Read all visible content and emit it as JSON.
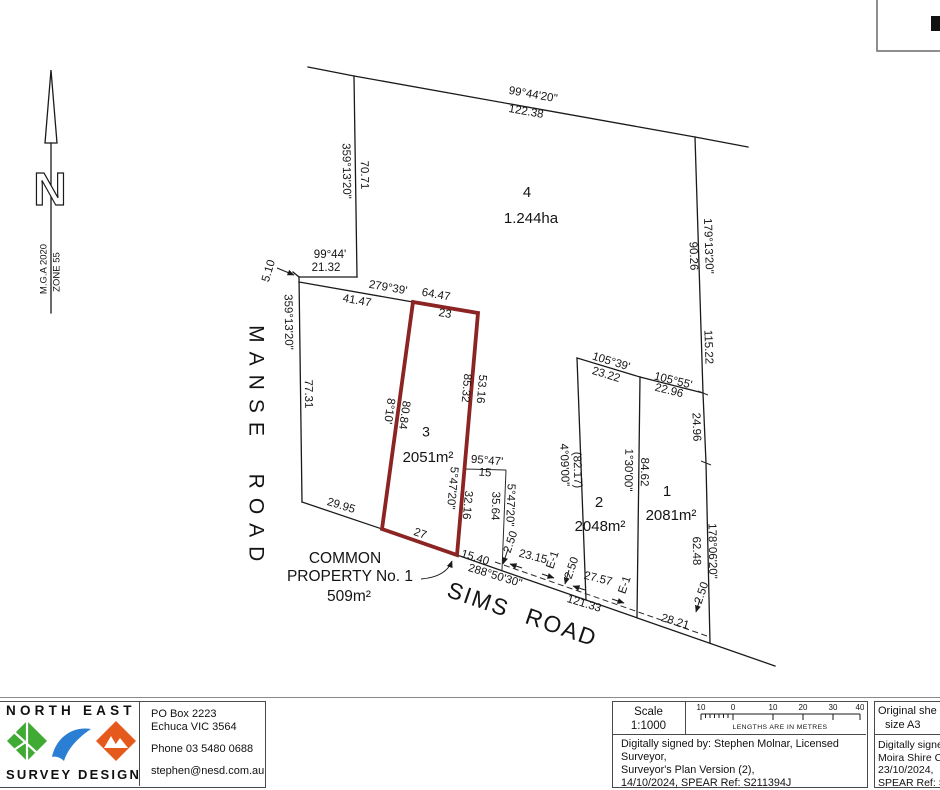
{
  "colors": {
    "lot_highlight": "#8b2423",
    "logo_green": "#3faa34",
    "logo_blue": "#2a7fd4",
    "logo_orange": "#e6591d"
  },
  "plan": {
    "labels": [
      {
        "n": "bearing-north-boundary",
        "t": "99°44'20\"",
        "x": 533,
        "y": 95,
        "r": 10
      },
      {
        "n": "distance-north-boundary",
        "t": "122.38",
        "x": 526,
        "y": 112,
        "r": 10
      },
      {
        "n": "bearing-lot4-west",
        "t": "359°13'20\"",
        "x": 346,
        "y": 171,
        "r": 89
      },
      {
        "n": "distance-lot4-west",
        "t": "70.71",
        "x": 364,
        "y": 175,
        "r": 89
      },
      {
        "n": "lot4-number",
        "t": "4",
        "x": 527,
        "y": 193,
        "s": 15
      },
      {
        "n": "lot4-area",
        "t": "1.244ha",
        "x": 531,
        "y": 219,
        "s": 15
      },
      {
        "n": "bearing-jog",
        "t": "99°44'",
        "x": 330,
        "y": 255
      },
      {
        "n": "distance-jog",
        "t": "21.32",
        "x": 326,
        "y": 268
      },
      {
        "n": "distance-splay",
        "t": "5.10",
        "x": 269,
        "y": 271,
        "r": -73
      },
      {
        "n": "bearing-279-39",
        "t": "279°39'",
        "x": 388,
        "y": 288,
        "r": 10
      },
      {
        "n": "distance-41-47",
        "t": "41.47",
        "x": 357,
        "y": 301,
        "r": 10
      },
      {
        "n": "distance-64-47",
        "t": "64.47",
        "x": 436,
        "y": 295,
        "r": 10
      },
      {
        "n": "distance-23",
        "t": "23",
        "x": 445,
        "y": 314,
        "r": 10
      },
      {
        "n": "bearing-manse-frontage",
        "t": "359°13'20\"",
        "x": 288,
        "y": 322,
        "r": 89
      },
      {
        "n": "distance-manse-frontage",
        "t": "77.31",
        "x": 308,
        "y": 394,
        "r": 89
      },
      {
        "n": "manse-road-name-1",
        "t": "MANSE",
        "x": 255,
        "y": 385,
        "r": 90,
        "s": 21,
        "ls": 9
      },
      {
        "n": "manse-road-name-2",
        "t": "ROAD",
        "x": 255,
        "y": 522,
        "r": 90,
        "s": 21,
        "ls": 9
      },
      {
        "n": "distance-29-95",
        "t": "29.95",
        "x": 341,
        "y": 506,
        "r": 17
      },
      {
        "n": "lot3-number",
        "t": "3",
        "x": 426,
        "y": 433,
        "s": 14
      },
      {
        "n": "lot3-area",
        "t": "2051m²",
        "x": 428,
        "y": 458,
        "s": 15
      },
      {
        "n": "bearing-lot3-west",
        "t": "8°10'",
        "x": 389,
        "y": 411,
        "r": 98
      },
      {
        "n": "distance-lot3-west",
        "t": "80.84",
        "x": 404,
        "y": 415,
        "r": 98
      },
      {
        "n": "distance-85-32",
        "t": "85.32",
        "x": 466,
        "y": 388,
        "r": 95
      },
      {
        "n": "distance-53-16",
        "t": "53.16",
        "x": 481,
        "y": 389,
        "r": 95
      },
      {
        "n": "bearing-lot3-east",
        "t": "5°47'20\"",
        "x": 452,
        "y": 488,
        "r": 95
      },
      {
        "n": "distance-32-16",
        "t": "32.16",
        "x": 467,
        "y": 505,
        "r": 95
      },
      {
        "n": "distance-27",
        "t": "27",
        "x": 420,
        "y": 534,
        "r": 19
      },
      {
        "n": "bearing-95-47",
        "t": "95°47'",
        "x": 487,
        "y": 461,
        "r": 5
      },
      {
        "n": "distance-15",
        "t": "15",
        "x": 485,
        "y": 473,
        "r": 5
      },
      {
        "n": "distance-35-64",
        "t": "35.64",
        "x": 495,
        "y": 506,
        "r": 92
      },
      {
        "n": "bearing-5-47-20",
        "t": "5°47'20\"",
        "x": 510,
        "y": 505,
        "r": 92
      },
      {
        "n": "bearing-lot2-west",
        "t": "4°09'00\"",
        "x": 564,
        "y": 465,
        "r": 88
      },
      {
        "n": "distance-lot2-west",
        "t": "(82.17)",
        "x": 577,
        "y": 470,
        "r": 88
      },
      {
        "n": "bearing-105-39",
        "t": "105°39'",
        "x": 611,
        "y": 362,
        "r": 17
      },
      {
        "n": "distance-23-22",
        "t": "23.22",
        "x": 606,
        "y": 375,
        "r": 17
      },
      {
        "n": "bearing-105-55",
        "t": "105°55'",
        "x": 673,
        "y": 381,
        "r": 14
      },
      {
        "n": "distance-22-96",
        "t": "22.96",
        "x": 669,
        "y": 391,
        "r": 14
      },
      {
        "n": "bearing-east-boundary",
        "t": "179°13'20\"",
        "x": 708,
        "y": 246,
        "r": 88
      },
      {
        "n": "distance-90-26",
        "t": "90.26",
        "x": 693,
        "y": 256,
        "r": 88
      },
      {
        "n": "distance-115-22",
        "t": "115.22",
        "x": 708,
        "y": 347,
        "r": 88
      },
      {
        "n": "distance-24-96",
        "t": "24.96",
        "x": 696,
        "y": 427,
        "r": 88
      },
      {
        "n": "lot2-number",
        "t": "2",
        "x": 599,
        "y": 503,
        "s": 15
      },
      {
        "n": "lot2-area",
        "t": "2048m²",
        "x": 600,
        "y": 527,
        "s": 15
      },
      {
        "n": "bearing-lot1-west",
        "t": "1°30'00\"",
        "x": 628,
        "y": 470,
        "r": 91
      },
      {
        "n": "distance-lot1-west",
        "t": "84.62",
        "x": 644,
        "y": 472,
        "r": 91
      },
      {
        "n": "lot1-number",
        "t": "1",
        "x": 667,
        "y": 492,
        "s": 15
      },
      {
        "n": "lot1-area",
        "t": "2081m²",
        "x": 671,
        "y": 516,
        "s": 15
      },
      {
        "n": "bearing-lot1-east",
        "t": "178°06'20\"",
        "x": 712,
        "y": 551,
        "r": 89
      },
      {
        "n": "distance-lot1-east",
        "t": "62.48",
        "x": 696,
        "y": 551,
        "r": 89
      },
      {
        "n": "distance-15-40",
        "t": "15.40",
        "x": 475,
        "y": 558,
        "r": 17
      },
      {
        "n": "bearing-sims-road",
        "t": "288°50'30\"",
        "x": 495,
        "y": 576,
        "r": 17
      },
      {
        "n": "distance-121-33",
        "t": "121.33",
        "x": 584,
        "y": 604,
        "r": 17
      },
      {
        "n": "distance-28-21",
        "t": "28.21",
        "x": 675,
        "y": 622,
        "r": 17
      },
      {
        "n": "sims-road-name-1",
        "t": "SIMS",
        "x": 478,
        "y": 601,
        "r": 19,
        "s": 23,
        "ls": 2
      },
      {
        "n": "sims-road-name-2",
        "t": "ROAD",
        "x": 561,
        "y": 629,
        "r": 19,
        "s": 23,
        "ls": 2
      },
      {
        "n": "easement-a-offset",
        "t": "2.50",
        "x": 511,
        "y": 542,
        "r": -71
      },
      {
        "n": "easement-a-length",
        "t": "23.15",
        "x": 533,
        "y": 557,
        "r": 14
      },
      {
        "n": "easement-a-label",
        "t": "E-1",
        "x": 553,
        "y": 560,
        "r": -71
      },
      {
        "n": "easement-b-offset",
        "t": "2.50",
        "x": 572,
        "y": 568,
        "r": -71
      },
      {
        "n": "easement-b-length",
        "t": "27.57",
        "x": 598,
        "y": 579,
        "r": 14
      },
      {
        "n": "easement-b-label",
        "t": "E-1",
        "x": 625,
        "y": 585,
        "r": -71
      },
      {
        "n": "easement-c-offset",
        "t": "2.50",
        "x": 702,
        "y": 593,
        "r": -71
      },
      {
        "n": "common-property-line-1",
        "t": "COMMON",
        "x": 345,
        "y": 559,
        "s": 15.5
      },
      {
        "n": "common-property-line-2",
        "t": "PROPERTY No. 1",
        "x": 350,
        "y": 577,
        "s": 15.5
      },
      {
        "n": "common-property-area",
        "t": "509m²",
        "x": 349,
        "y": 597,
        "s": 15.5
      },
      {
        "n": "north-datum",
        "t": "M.G.A 2020",
        "x": 44,
        "y": 269,
        "r": -90,
        "s": 9.5
      },
      {
        "n": "north-zone",
        "t": "ZONE 55",
        "x": 57,
        "y": 272,
        "r": -90,
        "s": 9.5
      },
      {
        "n": "north-letter",
        "t": "N",
        "x": 50,
        "y": 193,
        "s": 46,
        "cls": "hollow"
      }
    ]
  },
  "footer": {
    "company": {
      "name_top": "NORTH EAST",
      "name_bottom": "SURVEY DESIGN",
      "address1": "PO Box 2223",
      "address2": "Echuca VIC 3564",
      "phone": "Phone 03 5480 0688",
      "email": "stephen@nesd.com.au"
    },
    "scale": {
      "label": "Scale",
      "ratio": "1:1000",
      "bar_numbers": [
        "10",
        "0",
        "10",
        "20",
        "30",
        "40"
      ],
      "bar_caption": "LENGTHS ARE IN METRES"
    },
    "surveyor_signature": {
      "line1": "Digitally signed by: Stephen Molnar, Licensed Surveyor,",
      "line2": "Surveyor's Plan Version (2),",
      "line3": "14/10/2024, SPEAR Ref: S211394J"
    },
    "sheet": {
      "line1": "Original she",
      "line2": "size A3"
    },
    "council_signature": {
      "line1": "Digitally signed",
      "line2": "Moira Shire Co",
      "line3": "23/10/2024,",
      "line4": "SPEAR Ref: S2"
    }
  }
}
